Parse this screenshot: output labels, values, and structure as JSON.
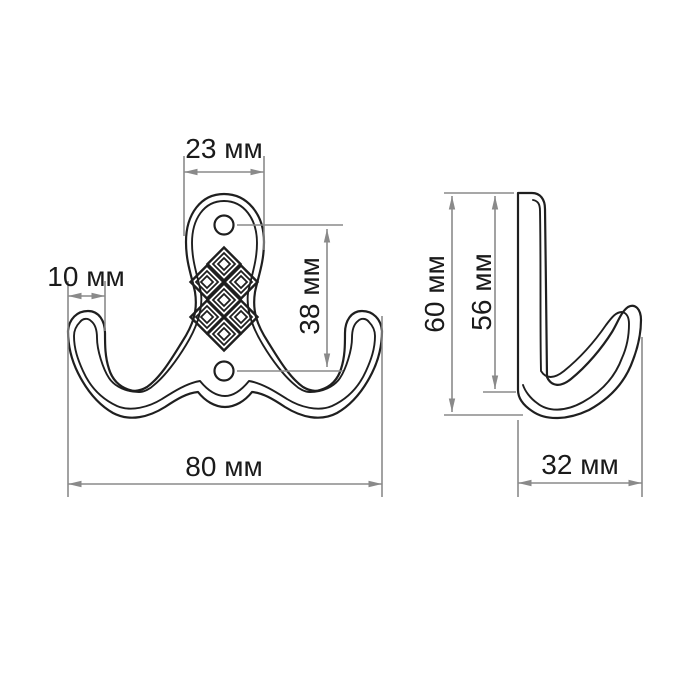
{
  "drawing": {
    "kind": "technical dimension drawing",
    "subject": "double coat hook, front and side projection views",
    "ornament": "lattice of 7 nested diamonds on front plate",
    "colors": {
      "background": "#ffffff",
      "outline": "#1f1f1f",
      "dimension_lines": "#8a8a8a",
      "label_text": "#1a1a1a"
    },
    "labels": {
      "front_top_width": "23 мм",
      "front_tip_width": "10 мм",
      "front_hole_spacing": "38 мм",
      "front_total_width": "80 мм",
      "side_total_height": "60 мм",
      "side_plate_height": "56 мм",
      "side_depth": "32 мм"
    }
  }
}
